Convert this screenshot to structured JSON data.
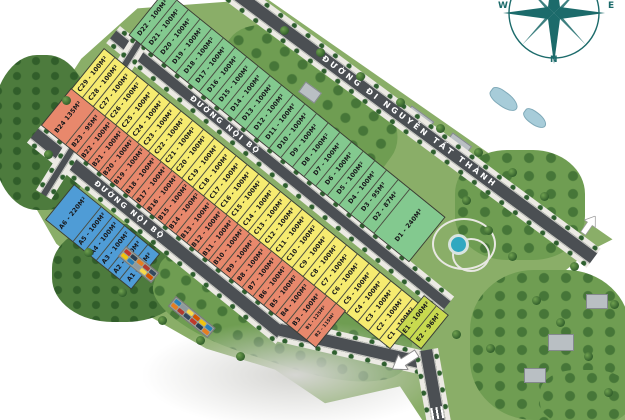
{
  "roads": {
    "main": "ĐƯỜNG ĐI NGUYỄN TẤT THÀNH",
    "internal_upper": "ĐƯỜNG NỘI BỘ",
    "internal_lower": "ĐƯỜNG NỘI BỘ"
  },
  "compass": {
    "west": "W",
    "east": "E",
    "north": "N"
  },
  "colors": {
    "zone_a": "#4f9cd6",
    "zone_b": "#e8886c",
    "zone_c": "#f6eb70",
    "zone_d": "#83c98f",
    "zone_e": "#c8da4f",
    "road": "#4b4f53",
    "sidewalk": "#eceae4",
    "grass": "#8aae68",
    "compass": "#1c6b6b"
  },
  "strips": {
    "D": {
      "zone": "d",
      "plots": [
        {
          "id": "D22",
          "label": "D22 - 100M²"
        },
        {
          "id": "D21",
          "label": "D21 - 100M²"
        },
        {
          "id": "D20",
          "label": "D20 - 100M²"
        },
        {
          "id": "D19",
          "label": "D19 - 100M²"
        },
        {
          "id": "D18",
          "label": "D18 - 100M²"
        },
        {
          "id": "D17",
          "label": "D17 - 100M²"
        },
        {
          "id": "D16",
          "label": "D16 - 100M²"
        },
        {
          "id": "D15",
          "label": "D15 - 100M²"
        },
        {
          "id": "D14",
          "label": "D14 - 100M²"
        },
        {
          "id": "D13",
          "label": "D13 - 100M²"
        },
        {
          "id": "D12",
          "label": "D12 - 100M²"
        },
        {
          "id": "D11",
          "label": "D11 - 100M²"
        },
        {
          "id": "D10",
          "label": "D10 - 100M²"
        },
        {
          "id": "D9",
          "label": "D9 - 100M²"
        },
        {
          "id": "D8",
          "label": "D8 - 100M²"
        },
        {
          "id": "D7",
          "label": "D7 - 100M²"
        },
        {
          "id": "D6",
          "label": "D6 - 100M²"
        },
        {
          "id": "D5",
          "label": "D5 - 100M²"
        },
        {
          "id": "D4",
          "label": "D4 - 100M²"
        },
        {
          "id": "D3",
          "label": "D3 - 95M²"
        },
        {
          "id": "D2",
          "label": "D2 - 87M²"
        },
        {
          "id": "D1",
          "label": "D1 - 240M²"
        }
      ]
    },
    "C": {
      "zone": "c",
      "plots": [
        {
          "id": "C29",
          "label": "C29 - 100M²"
        },
        {
          "id": "C28",
          "label": "C28 - 100M²"
        },
        {
          "id": "C27",
          "label": "C27 - 100M²"
        },
        {
          "id": "C26",
          "label": "C26 - 100M²"
        },
        {
          "id": "C25",
          "label": "C25 - 100M²"
        },
        {
          "id": "C24",
          "label": "C24 - 100M²"
        },
        {
          "id": "C23",
          "label": "C23 - 100M²"
        },
        {
          "id": "C22",
          "label": "C22 - 100M²"
        },
        {
          "id": "C21",
          "label": "C21 - 100M²"
        },
        {
          "id": "C20",
          "label": "C20 - 100M²"
        },
        {
          "id": "C19",
          "label": "C19 - 100M²"
        },
        {
          "id": "C18",
          "label": "C18 - 100M²"
        },
        {
          "id": "C17",
          "label": "C17 - 100M²"
        },
        {
          "id": "C16",
          "label": "C16 - 100M²"
        },
        {
          "id": "C15",
          "label": "C15 - 100M²"
        },
        {
          "id": "C14",
          "label": "C14 - 100M²"
        },
        {
          "id": "C13",
          "label": "C13 - 100M²"
        },
        {
          "id": "C12",
          "label": "C12 - 100M²"
        },
        {
          "id": "C11",
          "label": "C11 - 100M²"
        },
        {
          "id": "C10",
          "label": "C10 - 100M²"
        },
        {
          "id": "C9",
          "label": "C9 - 100M²"
        },
        {
          "id": "C8",
          "label": "C8 - 100M²"
        },
        {
          "id": "C7",
          "label": "C7 - 100M²"
        },
        {
          "id": "C6",
          "label": "C6 - 100M²"
        },
        {
          "id": "C5",
          "label": "C5 - 100M²"
        },
        {
          "id": "C4",
          "label": "C4 - 100M²"
        },
        {
          "id": "C3",
          "label": "C3 - 100M²"
        },
        {
          "id": "C2",
          "label": "C2 - 100M²"
        },
        {
          "id": "C1",
          "label": "C1 - 100M²"
        }
      ]
    },
    "B": {
      "zone": "b",
      "plots": [
        {
          "id": "B24",
          "label": "B24 135M²"
        },
        {
          "id": "B23",
          "label": "B23 - 95M²"
        },
        {
          "id": "B22",
          "label": "B22 - 100M²"
        },
        {
          "id": "B21",
          "label": "B21 - 100M²"
        },
        {
          "id": "B20",
          "label": "B20 - 100M²"
        },
        {
          "id": "B19",
          "label": "B19 - 100M²"
        },
        {
          "id": "B18",
          "label": "B18 - 100M²"
        },
        {
          "id": "B17",
          "label": "B17 - 100M²"
        },
        {
          "id": "B16",
          "label": "B16 - 100M²"
        },
        {
          "id": "B15",
          "label": "B15 - 100M²"
        },
        {
          "id": "B14",
          "label": "B14 - 100M²"
        },
        {
          "id": "B13",
          "label": "B13 - 100M²"
        },
        {
          "id": "B12",
          "label": "B12 - 100M²"
        },
        {
          "id": "B11",
          "label": "B11 - 100M²"
        },
        {
          "id": "B10",
          "label": "B10 - 100M²"
        },
        {
          "id": "B9",
          "label": "B9 - 100M²"
        },
        {
          "id": "B8",
          "label": "B8 - 100M²"
        },
        {
          "id": "B7",
          "label": "B7 - 100M²"
        },
        {
          "id": "B6",
          "label": "B6 - 100M²"
        },
        {
          "id": "B5",
          "label": "B5 - 100M²"
        },
        {
          "id": "B4",
          "label": "B4 - 100M²"
        },
        {
          "id": "B3",
          "label": "B3 - 100M²"
        },
        {
          "id": "B1",
          "label": "B1 - 125M²"
        },
        {
          "id": "B2",
          "label": "B2 - 115M²"
        }
      ]
    },
    "A": {
      "zone": "a",
      "plots": [
        {
          "id": "A6",
          "label": "A6 - 220M²"
        },
        {
          "id": "A5",
          "label": "A5 - 100M²"
        },
        {
          "id": "A4",
          "label": "A4 - 100M²"
        },
        {
          "id": "A3",
          "label": "A3 - 100M²"
        },
        {
          "id": "A2",
          "label": "A2 - 100M²"
        },
        {
          "id": "A1",
          "label": "A1 - 86M²"
        }
      ]
    },
    "E": {
      "zone": "e",
      "plots": [
        {
          "id": "E1",
          "label": "E1 - 100M²"
        },
        {
          "id": "E2",
          "label": "E2 - 96M²"
        }
      ]
    }
  }
}
